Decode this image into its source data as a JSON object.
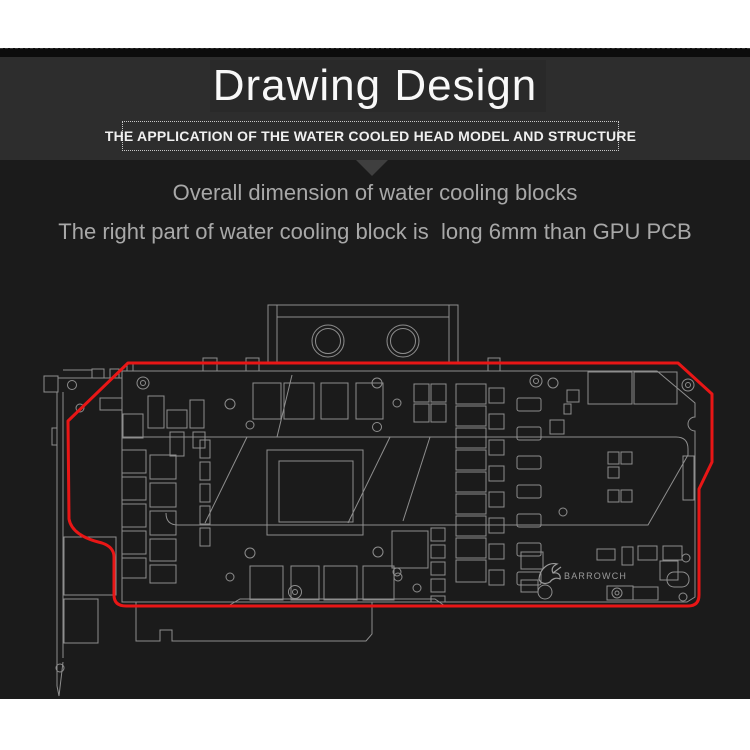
{
  "header": {
    "title": "Drawing Design",
    "subtitle": "THE APPLICATION OF THE WATER COOLED HEAD MODEL AND STRUCTURE"
  },
  "body": {
    "line1": "Overall dimension of water cooling blocks",
    "line2": "The right part of water cooling block is  long 6mm than GPU PCB"
  },
  "colors": {
    "page_bg": "#ffffff",
    "panel_bg": "#1b1b1b",
    "strip_bg": "#0c0c0c",
    "header_bg": "#2d2d2d",
    "title_backdrop_bg": "#292929",
    "title_color": "#f8f8f8",
    "subtitle_color": "#f0f0f0",
    "pointer_color": "#3f3f3f",
    "body_text_color": "#a8a8a8",
    "wireframe_stroke": "#8e8e8e",
    "red_outline": "#e81616",
    "logo_color": "#9a9a9a"
  },
  "drawing": {
    "logo_text": "BARROWCH",
    "red_outline_path": "M128,363 L678,363 L712,394 L712,462 L699,489 L699,595 Q699,606 688,606 L126,606 Q114,606 114,595 L114,557 Q114,547 102,543 Q72,536 69,519 L68,421 Z",
    "logo_mark_path": "M539,579 C540,568 549,562 557,564 C553,566 551,569 553,573 C558,572 561,575 560,579 C556,577 552,579 550,582 C545,585 540,583 539,579 Z M553,573 L561,567",
    "gray_paths": [
      "M122,371 L657,371 L695,403 L695,417 A7 7 0 0 0 695,431 L695,597 L687,602 L122,602 Z",
      "M136,602 L136,641 L160,641 L160,630 L172,630 L172,641 L366,641 L372,634 L372,602",
      "M122,437 L676,437 Q688,437 688,449 L688,455 L648,525 L178,525 Q166,525 166,513",
      "M228,606 L240,599 L435,599 L445,606",
      "M57,686 L59,696 L63,662",
      "M63,370 L92,370"
    ],
    "lines": [
      [
        57,
        392,
        57,
        686
      ],
      [
        63,
        392,
        63,
        658
      ],
      [
        58,
        378,
        122,
        378
      ],
      [
        277,
        305,
        277,
        362
      ],
      [
        449,
        305,
        449,
        362
      ],
      [
        277,
        317,
        449,
        317
      ],
      [
        247,
        437,
        205,
        523
      ],
      [
        292,
        375,
        277,
        437
      ],
      [
        390,
        437,
        348,
        523
      ],
      [
        430,
        437,
        403,
        521
      ]
    ],
    "rects": [
      [
        268,
        305,
        190,
        58
      ],
      [
        44,
        376,
        14,
        16
      ],
      [
        52,
        428,
        5,
        17
      ],
      [
        64,
        537,
        52,
        58
      ],
      [
        64,
        599,
        34,
        44
      ],
      [
        92,
        369,
        12,
        9
      ],
      [
        110,
        369,
        9,
        9
      ],
      [
        127,
        364,
        6,
        7
      ],
      [
        203,
        358,
        14,
        13
      ],
      [
        246,
        358,
        13,
        13
      ],
      [
        488,
        358,
        12,
        13
      ],
      [
        100,
        398,
        22,
        12
      ],
      [
        253,
        383,
        28,
        36
      ],
      [
        284,
        383,
        30,
        36
      ],
      [
        321,
        383,
        27,
        36
      ],
      [
        356,
        383,
        27,
        36
      ],
      [
        250,
        566,
        33,
        34
      ],
      [
        291,
        566,
        28,
        34
      ],
      [
        324,
        566,
        33,
        34
      ],
      [
        363,
        566,
        31,
        34
      ],
      [
        267,
        450,
        96,
        85
      ],
      [
        279,
        461,
        74,
        61
      ],
      [
        123,
        414,
        20,
        24
      ],
      [
        148,
        396,
        16,
        32
      ],
      [
        167,
        410,
        20,
        18
      ],
      [
        170,
        432,
        14,
        24
      ],
      [
        190,
        400,
        14,
        28
      ],
      [
        193,
        432,
        12,
        16
      ],
      [
        122,
        450,
        24,
        23
      ],
      [
        122,
        477,
        24,
        23
      ],
      [
        122,
        504,
        24,
        23
      ],
      [
        122,
        531,
        24,
        23
      ],
      [
        122,
        558,
        24,
        20
      ],
      [
        150,
        455,
        26,
        24
      ],
      [
        150,
        483,
        26,
        24
      ],
      [
        150,
        511,
        26,
        24
      ],
      [
        150,
        539,
        26,
        22
      ],
      [
        150,
        565,
        26,
        18
      ],
      [
        200,
        440,
        10,
        18
      ],
      [
        200,
        462,
        10,
        18
      ],
      [
        200,
        484,
        10,
        18
      ],
      [
        200,
        506,
        10,
        18
      ],
      [
        200,
        528,
        10,
        18
      ],
      [
        414,
        384,
        15,
        18
      ],
      [
        431,
        384,
        15,
        18
      ],
      [
        414,
        404,
        15,
        18
      ],
      [
        431,
        404,
        15,
        18
      ],
      [
        456,
        384,
        30,
        20
      ],
      [
        456,
        406,
        30,
        20
      ],
      [
        456,
        428,
        30,
        20
      ],
      [
        456,
        450,
        30,
        20
      ],
      [
        456,
        472,
        30,
        20
      ],
      [
        456,
        494,
        30,
        20
      ],
      [
        456,
        516,
        30,
        20
      ],
      [
        456,
        538,
        30,
        20
      ],
      [
        456,
        560,
        30,
        22
      ],
      [
        489,
        388,
        15,
        15
      ],
      [
        489,
        414,
        15,
        15
      ],
      [
        489,
        440,
        15,
        15
      ],
      [
        489,
        466,
        15,
        15
      ],
      [
        489,
        492,
        15,
        15
      ],
      [
        489,
        518,
        15,
        15
      ],
      [
        489,
        544,
        15,
        15
      ],
      [
        489,
        570,
        15,
        15
      ],
      [
        517,
        398,
        24,
        13,
        2
      ],
      [
        517,
        427,
        24,
        13,
        2
      ],
      [
        517,
        456,
        24,
        13,
        2
      ],
      [
        517,
        485,
        24,
        13,
        2
      ],
      [
        517,
        514,
        24,
        13,
        2
      ],
      [
        517,
        543,
        24,
        13,
        2
      ],
      [
        517,
        572,
        24,
        13,
        2
      ],
      [
        588,
        372,
        44,
        32
      ],
      [
        634,
        372,
        43,
        32
      ],
      [
        567,
        390,
        12,
        12
      ],
      [
        564,
        404,
        7,
        10
      ],
      [
        550,
        420,
        14,
        14
      ],
      [
        608,
        452,
        11,
        12
      ],
      [
        621,
        452,
        11,
        12
      ],
      [
        608,
        467,
        11,
        11
      ],
      [
        608,
        490,
        11,
        12
      ],
      [
        621,
        490,
        11,
        12
      ],
      [
        683,
        456,
        11,
        44
      ],
      [
        392,
        531,
        36,
        37
      ],
      [
        431,
        528,
        14,
        13
      ],
      [
        431,
        545,
        14,
        13
      ],
      [
        431,
        562,
        14,
        13
      ],
      [
        431,
        579,
        14,
        13
      ],
      [
        431,
        596,
        14,
        6
      ],
      [
        521,
        552,
        22,
        17
      ],
      [
        521,
        580,
        17,
        12
      ],
      [
        597,
        549,
        18,
        11
      ],
      [
        622,
        547,
        11,
        18
      ],
      [
        638,
        546,
        19,
        14
      ],
      [
        663,
        546,
        19,
        14
      ],
      [
        660,
        561,
        18,
        19
      ],
      [
        667,
        572,
        22,
        15,
        7
      ],
      [
        607,
        586,
        26,
        14
      ],
      [
        633,
        587,
        25,
        13
      ]
    ],
    "circles": [
      [
        328,
        341,
        16
      ],
      [
        328,
        341,
        12.5
      ],
      [
        403,
        341,
        16
      ],
      [
        403,
        341,
        12.5
      ],
      [
        72,
        385,
        4.5
      ],
      [
        80,
        408,
        4
      ],
      [
        60,
        668,
        4
      ],
      [
        143,
        383,
        6
      ],
      [
        143,
        383,
        2.5
      ],
      [
        230,
        404,
        5
      ],
      [
        250,
        425,
        4
      ],
      [
        377,
        383,
        5
      ],
      [
        397,
        403,
        4
      ],
      [
        377,
        427,
        4.5
      ],
      [
        536,
        381,
        6
      ],
      [
        536,
        381,
        2.5
      ],
      [
        553,
        383,
        5
      ],
      [
        688,
        385,
        6
      ],
      [
        688,
        385,
        2.5
      ],
      [
        250,
        553,
        5
      ],
      [
        378,
        552,
        5
      ],
      [
        230,
        577,
        4
      ],
      [
        398,
        577,
        4
      ],
      [
        397,
        572,
        4
      ],
      [
        417,
        588,
        4
      ],
      [
        295,
        592,
        6.5
      ],
      [
        295,
        592,
        2.5
      ],
      [
        563,
        512,
        4
      ],
      [
        686,
        558,
        4
      ],
      [
        683,
        597,
        4
      ],
      [
        617,
        593,
        5
      ],
      [
        617,
        593,
        2
      ],
      [
        545,
        592,
        7
      ]
    ]
  }
}
